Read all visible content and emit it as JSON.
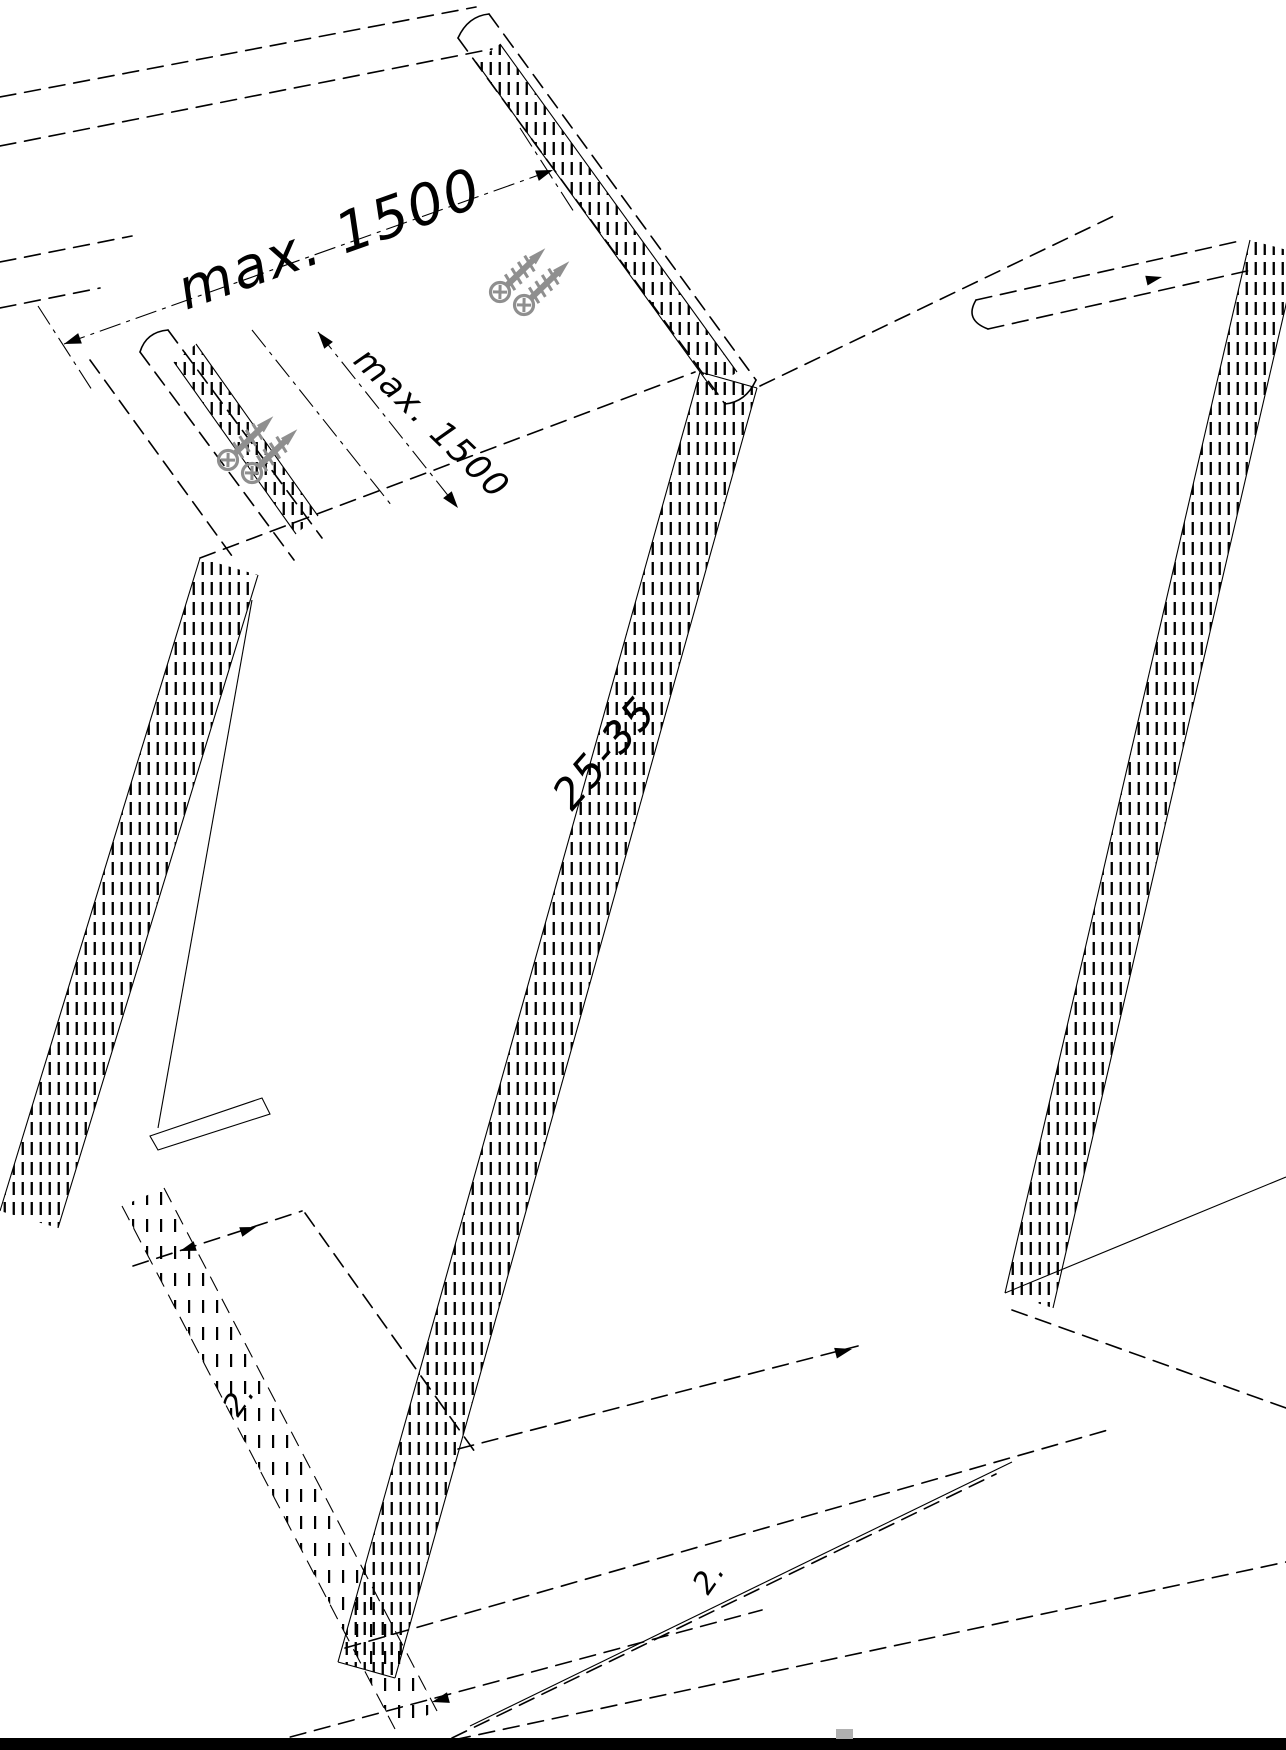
{
  "drawing": {
    "type": "isometric installation drawing of panels fixed to battens",
    "background": "#ffffff",
    "line_color": "#000000",
    "screw_color": "#8f8f8f",
    "bottom_bar_color": "#000000",
    "chip_color": "#b0b0b0",
    "labels": {
      "dim_top": "max. 1500",
      "dim_side": "max. 1500",
      "joint_note": "25-35",
      "step_left": "2.",
      "step_right": "2."
    }
  }
}
